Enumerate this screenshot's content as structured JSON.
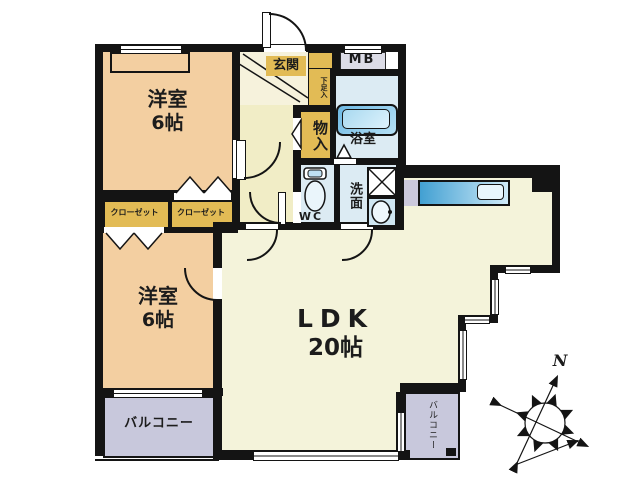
{
  "rooms": {
    "bedroom1": {
      "name": "洋室",
      "size": "6帖"
    },
    "bedroom2": {
      "name": "洋室",
      "size": "6帖"
    },
    "ldk": {
      "name": "LDK",
      "size": "20帖"
    },
    "entrance": {
      "label": "玄関"
    },
    "meter_box": {
      "label": "MB"
    },
    "shoe_cabinet": {
      "label": "下足入"
    },
    "storage": {
      "label": "物入"
    },
    "bathroom": {
      "label": "浴室"
    },
    "washroom": {
      "label": "洗面"
    },
    "toilet": {
      "label": "WC"
    },
    "closet_left": {
      "label": "クローゼット"
    },
    "closet_right": {
      "label": "クローゼット"
    },
    "balcony_left": {
      "label": "バルコニー"
    },
    "balcony_right": {
      "label": "バルコニー"
    }
  },
  "compass": {
    "north_label": "N"
  },
  "colors": {
    "wall": "#141414",
    "bedroom": "#f3cfa1",
    "hall": "#f1edc6",
    "genkan": "#f6f2dc",
    "ldk": "#f4f3da",
    "accent_gold": "#e2bb55",
    "wet_area": "#dcebf3",
    "balcony": "#c8c8dc",
    "meter_box": "#dcdce6",
    "kitchen_counter_dark": "#42a0d2",
    "kitchen_counter_light": "#cfeaf8"
  }
}
